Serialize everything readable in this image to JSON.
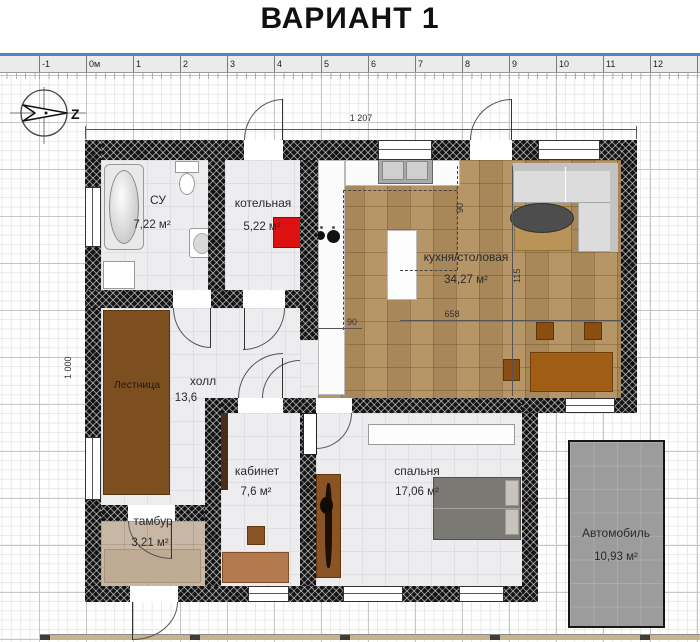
{
  "title": "ВАРИАНТ 1",
  "compass": {
    "label": "Z"
  },
  "ruler": {
    "labels": [
      "-1",
      "0м",
      "1",
      "2",
      "3",
      "4",
      "5",
      "6",
      "7",
      "8",
      "9",
      "10",
      "11",
      "12",
      "13"
    ]
  },
  "dimensions": {
    "building_width": "1 207",
    "building_height": "1 000",
    "kitchen_zone_width": "658",
    "kitchen_pass_width": "90",
    "kitchen_zone_depth": "90",
    "dining_depth": "115"
  },
  "rooms": {
    "su": {
      "name": "СУ",
      "area": "7,22 м²"
    },
    "boiler": {
      "name": "котельная",
      "area": "5,22 м²"
    },
    "kitchen": {
      "name": "кухня/столовая",
      "area": "34,27 м²"
    },
    "stairs": {
      "name": "Лестница"
    },
    "hall": {
      "name": "холл",
      "area": "13,6"
    },
    "office": {
      "name": "кабинет",
      "area": "7,6 м²"
    },
    "bedroom": {
      "name": "спальня",
      "area": "17,06 м²"
    },
    "tambour": {
      "name": "тамбур",
      "area": "3,21 м²"
    },
    "car": {
      "name": "Автомобиль",
      "area": "10,93 м²"
    }
  },
  "colors": {
    "wall": "#141414",
    "kitchen_floor": "#b2905f",
    "tile_floor": "#ededef",
    "tambour_floor": "#c9b7a6",
    "boiler_unit": "#dd1111",
    "car_area": "#9c9c9c",
    "ruler_accent": "#4d86c6",
    "furniture_wood": "#a05d15",
    "stairs_wood": "#7d4e1f"
  }
}
